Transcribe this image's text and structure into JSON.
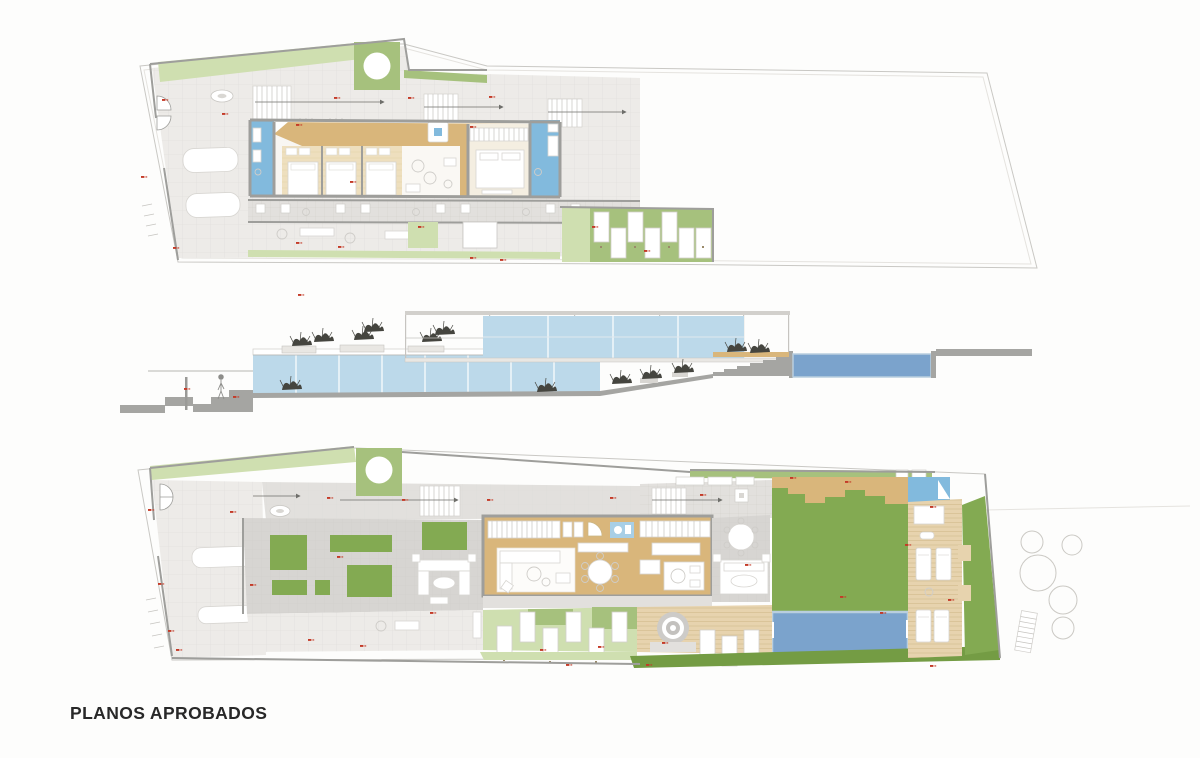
{
  "page": {
    "title": "PLANOS APROBADOS"
  },
  "colors": {
    "paper": "#fdfdfc",
    "title_ink": "#282828",
    "outline": "#c9c8c4",
    "wall_gray": "#9e9e9b",
    "tile_light": "#edebe8",
    "tile_mid": "#e2e0dd",
    "tile_dark": "#d7d5d2",
    "green_light": "#cfdfb0",
    "green_mid": "#a6c17d",
    "green_lawn": "#83aa52",
    "green_dark": "#749c44",
    "pool_blue": "#7ba3cc",
    "pool_edge": "#b9cede",
    "glass_blue": "#bcd9ea",
    "bath_blue": "#82badd",
    "wood_tan": "#d9b67b",
    "wood_light": "#eedfbe",
    "deck_tan": "#e7d3ae",
    "marker_red": "#c43a27"
  }
}
